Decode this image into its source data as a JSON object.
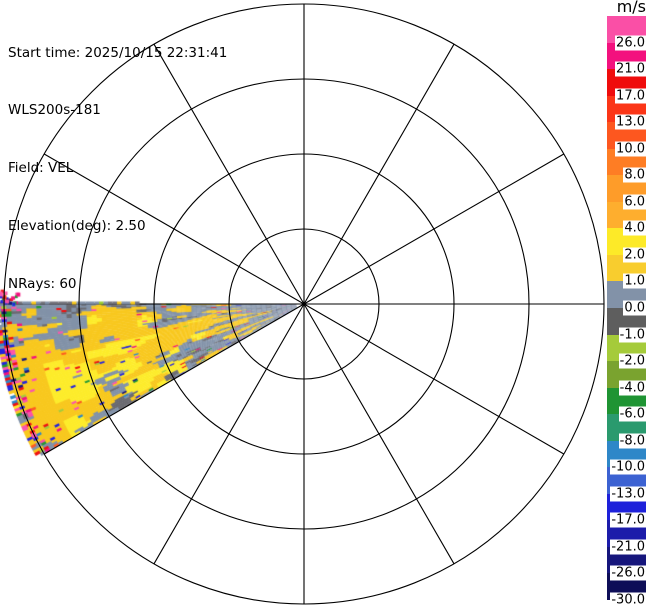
{
  "header": {
    "lines": [
      "Start time: 2025/10/15 22:31:41",
      "WLS200s-181",
      "Field: VEL",
      "Elevation(deg): 2.50",
      "NRays: 60"
    ]
  },
  "colorbar": {
    "unit": "m/s",
    "ticks": [
      "26.0",
      "21.0",
      "17.0",
      "13.0",
      "10.0",
      "8.0",
      "6.0",
      "4.0",
      "2.0",
      "1.0",
      "0.0",
      "-1.0",
      "-2.0",
      "-4.0",
      "-6.0",
      "-8.0",
      "-10.0",
      "-13.0",
      "-17.0",
      "-21.0",
      "-26.0",
      "-30.0"
    ],
    "segment_colors": [
      "#fa4fa6",
      "#f3117e",
      "#ef0c0c",
      "#fb3517",
      "#fd571f",
      "#fe7d24",
      "#fe9c29",
      "#feae2e",
      "#fdea28",
      "#f8cd2e",
      "#8292a8",
      "#5e5e5e",
      "#a5cb3a",
      "#7aa32f",
      "#1f9433",
      "#2a9a6e",
      "#2e87c8",
      "#3c62d2",
      "#1e21da",
      "#1c1caa",
      "#16167c",
      "#0e0e58"
    ],
    "geometry_px": {
      "left": 607,
      "top": 16,
      "width": 39,
      "height": 584
    }
  },
  "chart_data": {
    "type": "ppi_polar_velocity_scan",
    "instrument": "WLS200s-181",
    "field": "VEL",
    "elevation_deg": 2.5,
    "nrays": 60,
    "start_time": "2025/10/15 22:31:41",
    "unit": "m/s",
    "colorbar_boundaries_mps": [
      30,
      26,
      21,
      17,
      13,
      10,
      8,
      6,
      4,
      2,
      1,
      0,
      -1,
      -2,
      -4,
      -6,
      -8,
      -10,
      -13,
      -17,
      -21,
      -26,
      -30
    ],
    "grid": {
      "center_px": [
        304,
        304
      ],
      "range_ring_radii_px": [
        75,
        150,
        225,
        300
      ],
      "spoke_step_deg": 30,
      "line_color": "#000000"
    },
    "sector": {
      "azimuth_start_deg": 240,
      "azimuth_end_deg": 270,
      "beam_width_deg": 0.5,
      "r_min_px": 8,
      "r_max_px": 306,
      "gate_px": 5,
      "description": "30-degree data wedge pointing west to west-southwest from center, clipped at left image edge"
    },
    "observed_pattern": {
      "dominant": "slate-gray cells (0..1 m/s) with large gold/bright-yellow patches (1..4 m/s)",
      "negative_patches": "scattered dark-gray cells (-1..0 m/s), denser near top edge mid-range and along bottom edge",
      "bright_yellow_zone": "large lemon-yellow mass in lower-central part of wedge",
      "rim_noise": "dense multicolor (pink/magenta/red/blue/green) aliased speckle near maximum range, plus speckle spill just above the west edge at far left",
      "first_ray": "thin gray ray lying along the 270-degree spoke from x=0 to x=139"
    },
    "palette": {
      "slate": "#8292a8",
      "darkGray": "#6a6a70",
      "midGray": "#74747c",
      "gold": "#f8c81e",
      "yellow": "#fdec2a",
      "green_speck": "#9acd32",
      "speck_colors": [
        "#f3117e",
        "#fb56ab",
        "#ee1111",
        "#2222dd",
        "#fd5b20",
        "#229932",
        "#a5cb3a",
        "#2e87c8",
        "#16167c",
        "#fb56ab",
        "#f3117e",
        "#ee1111",
        "#2222dd",
        "#fa4fa6"
      ]
    },
    "mosaic_seed": 7
  }
}
